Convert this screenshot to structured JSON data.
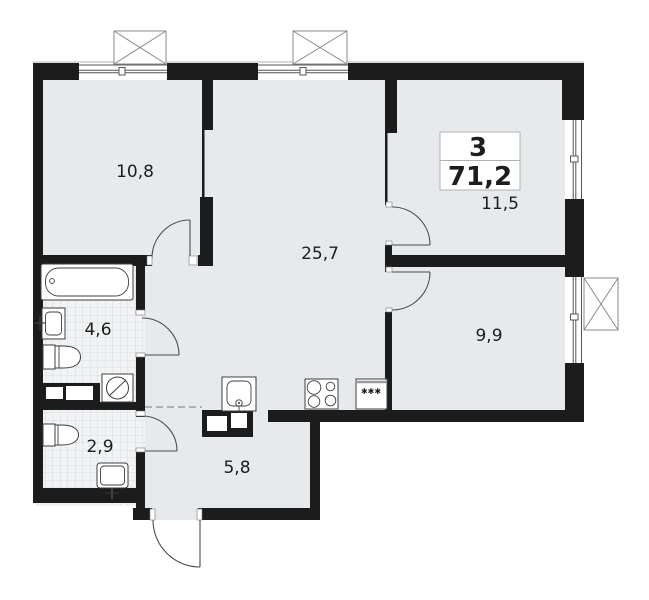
{
  "floor_plan": {
    "summary": {
      "rooms_count": "3",
      "total_area": "71,2"
    },
    "rooms": [
      {
        "key": "bedroom-top-left",
        "area": "10,8"
      },
      {
        "key": "living-kitchen",
        "area": "25,7"
      },
      {
        "key": "bedroom-top-right",
        "area": "11,5"
      },
      {
        "key": "bedroom-right",
        "area": "9,9"
      },
      {
        "key": "bathroom",
        "area": "4,6"
      },
      {
        "key": "wc",
        "area": "2,9"
      },
      {
        "key": "hallway",
        "area": "5,8"
      }
    ],
    "fixtures": [
      "bathtub",
      "washbasin",
      "toilet",
      "washing-machine",
      "toilet-small",
      "washbasin-small",
      "kitchen-sink",
      "stove",
      "fridge"
    ],
    "fridge_marks": "✱✱✱",
    "colors": {
      "wall": "#1c1c1c",
      "floor": "#e7eaed",
      "tile_floor": "#f1f3f4",
      "tile_line": "#d8dce0",
      "fixture_outline": "#3f3f3f",
      "door_line": "#4a4a4a",
      "hatch_box_outline": "#8a8a8a",
      "info_box_border": "#b0b0b0"
    }
  }
}
